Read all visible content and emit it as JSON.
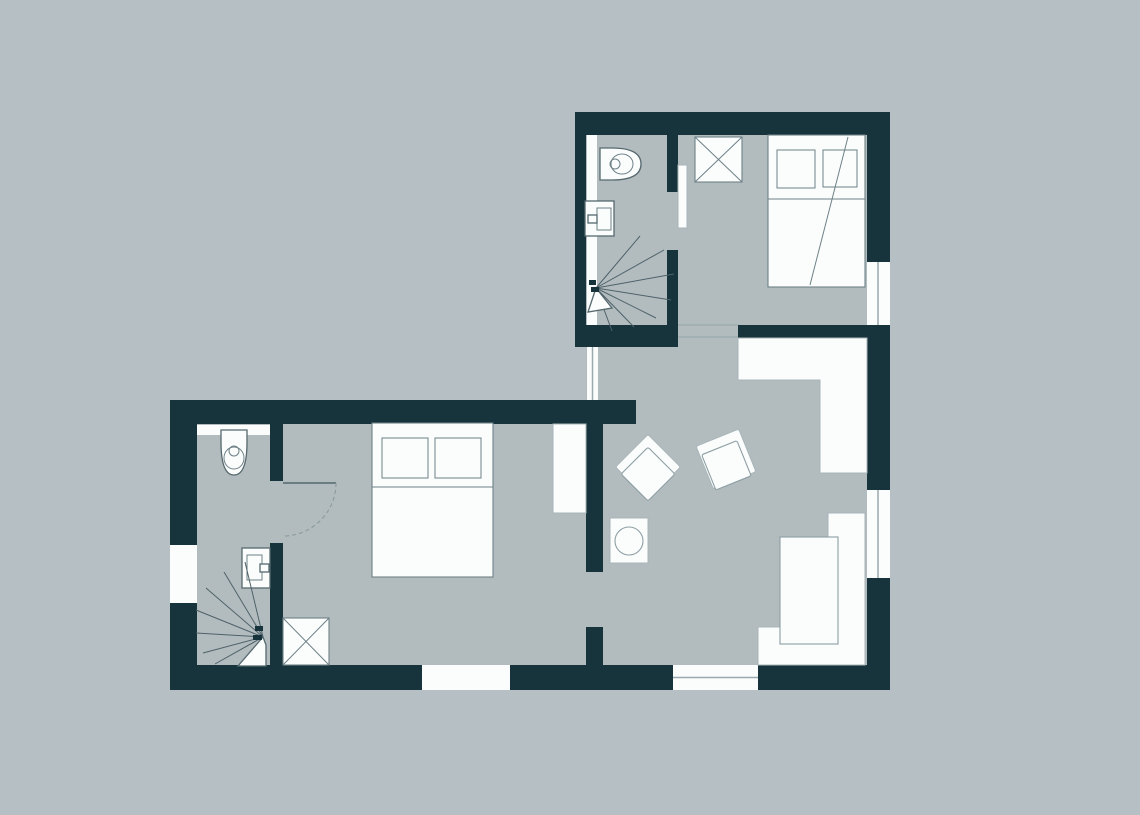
{
  "title": "apartment-floor-plan",
  "colors": {
    "bg": "#b6c0c4",
    "floor": "#b2bcbf",
    "wall": "#17333c",
    "white": "#fbfdfd",
    "fixture-stroke": "#55686e",
    "furn-stroke": "#6e8187",
    "light-stroke": "#a9b5b9",
    "seat-stroke": "#8d9ea3",
    "stair-stroke": "#4e6168",
    "faint": "#9aa9ad",
    "dash": "#8a9a9e"
  },
  "inventory": {
    "upper_unit": {
      "bathroom_fixtures": [
        "toilet",
        "washbasin",
        "spiral-staircase",
        "wall-strip"
      ],
      "bedroom_fixtures": [
        "double-bed",
        "two-pillows",
        "throw-line",
        "crossed-wardrobe",
        "sliding-door"
      ],
      "windows": [
        "right-wall-window"
      ]
    },
    "lower_unit": {
      "bathroom_fixtures": [
        "toilet",
        "washbasin",
        "spiral-staircase",
        "radiator-band",
        "swing-door"
      ],
      "bedroom_fixtures": [
        "double-bed",
        "two-pillows",
        "crossed-wardrobe",
        "tall-cabinet"
      ],
      "living_room_fixtures": [
        "kitchen-counter-l",
        "armchair",
        "armchair",
        "side-table-with-lamp",
        "corner-sofa",
        "sofa-seat"
      ],
      "windows": [
        "left-wall-window",
        "bottom-wall-window-bedroom",
        "bottom-wall-window-living",
        "right-wall-window"
      ],
      "openings": [
        "living-room-passage",
        "upper-connection-lines"
      ]
    }
  }
}
